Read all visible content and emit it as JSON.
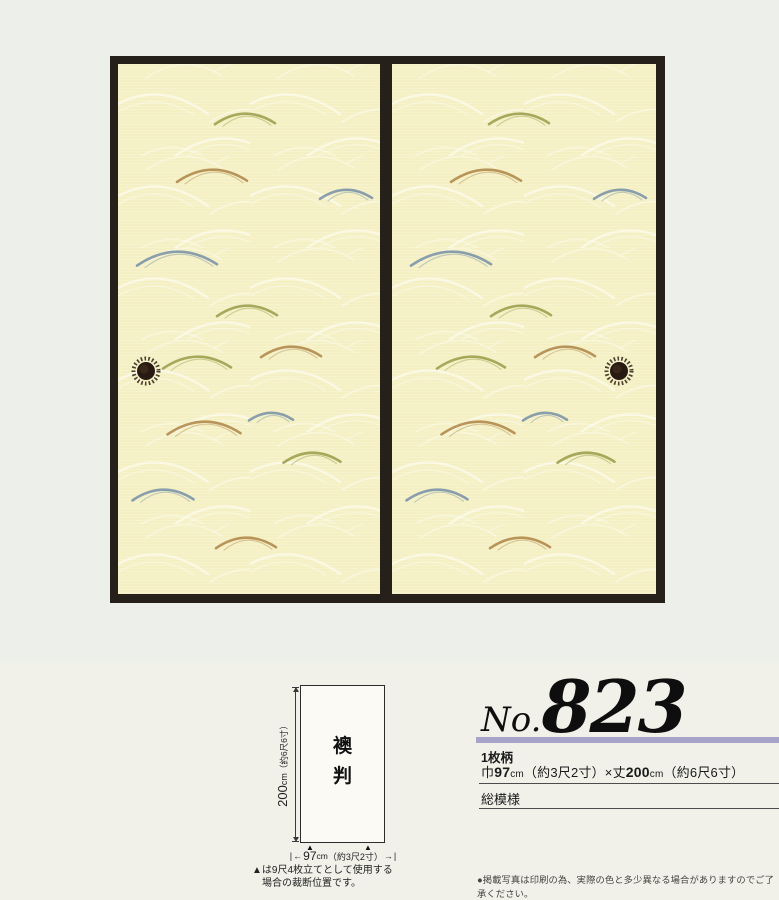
{
  "page": {
    "bg_top": "#edf0ea",
    "bg_bottom": "#f1f1ea"
  },
  "photo": {
    "frame_color": "#25201a",
    "panel_bg": "#f4f0c3",
    "wave_color": "#ffffff",
    "panels": [
      {
        "side": "left"
      },
      {
        "side": "right"
      }
    ],
    "accent_colors": {
      "olive": "#9da04f",
      "tan": "#b28a4e",
      "blue": "#7d95a8"
    },
    "accent_arcs": [
      {
        "x": 127,
        "y": 50,
        "w": 60,
        "c": "olive"
      },
      {
        "x": 94,
        "y": 106,
        "w": 70,
        "c": "tan"
      },
      {
        "x": 228,
        "y": 126,
        "w": 52,
        "c": "blue"
      },
      {
        "x": 59,
        "y": 188,
        "w": 80,
        "c": "blue"
      },
      {
        "x": 129,
        "y": 242,
        "w": 60,
        "c": "olive"
      },
      {
        "x": 173,
        "y": 283,
        "w": 60,
        "c": "tan"
      },
      {
        "x": 79,
        "y": 293,
        "w": 68,
        "c": "olive"
      },
      {
        "x": 86,
        "y": 358,
        "w": 73,
        "c": "tan"
      },
      {
        "x": 153,
        "y": 349,
        "w": 44,
        "c": "blue"
      },
      {
        "x": 194,
        "y": 389,
        "w": 57,
        "c": "olive"
      },
      {
        "x": 45,
        "y": 426,
        "w": 61,
        "c": "blue"
      },
      {
        "x": 128,
        "y": 474,
        "w": 60,
        "c": "tan"
      }
    ],
    "handle": {
      "ring": "#3a2b1e",
      "center": "#281a12"
    }
  },
  "diagram": {
    "panel_label_chars": [
      "襖",
      "判"
    ],
    "height_value": "200",
    "height_unit": "cm",
    "height_paren": "（約6尺6寸）",
    "width_value": "97",
    "width_unit": "cm",
    "width_paren": "（約3尺2寸）",
    "cut_marker": "▲",
    "note_line1": "▲は9尺4枚立てとして使用する",
    "note_line2": "場合の裁断位置です。"
  },
  "product": {
    "no_prefix": "No.",
    "number": "823",
    "bar_color": "#a8a3c9",
    "type_label": "1枚柄",
    "size_parts": [
      {
        "t": "巾",
        "cls": "n"
      },
      {
        "t": "97",
        "cls": "b"
      },
      {
        "t": "cm",
        "cls": "s"
      },
      {
        "t": "（約3尺2寸）×丈",
        "cls": "n"
      },
      {
        "t": "200",
        "cls": "b"
      },
      {
        "t": "cm",
        "cls": "s"
      },
      {
        "t": "（約6尺6寸）",
        "cls": "n"
      }
    ],
    "pattern_label": "総模様",
    "footnote": "●掲載写真は印刷の為、実際の色と多少異なる場合がありますのでご了承ください。"
  }
}
